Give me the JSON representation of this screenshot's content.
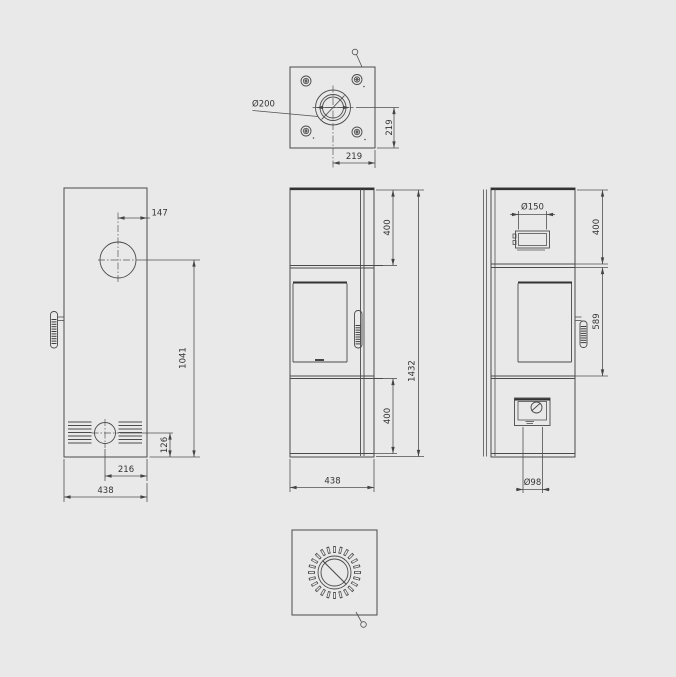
{
  "drawing": {
    "title": "stove-dimension-drawing",
    "colors": {
      "background": "#e9e9e9",
      "line": "#4a4a4a",
      "text": "#333333"
    },
    "views": {
      "top": {
        "flue_diameter": "Ø200",
        "offset_vertical": "219",
        "offset_horizontal": "219"
      },
      "back": {
        "flue_offset": "147",
        "flue_center_height": "1041",
        "vent_center_height": "126",
        "vent_offset": "216",
        "width": "438"
      },
      "front": {
        "top_section_height": "400",
        "total_height": "1432",
        "bottom_section_height": "400",
        "width": "438"
      },
      "side": {
        "collar_diameter": "Ø150",
        "top_section_height": "400",
        "door_section_height": "589",
        "air_inlet_diameter": "Ø98"
      }
    }
  }
}
